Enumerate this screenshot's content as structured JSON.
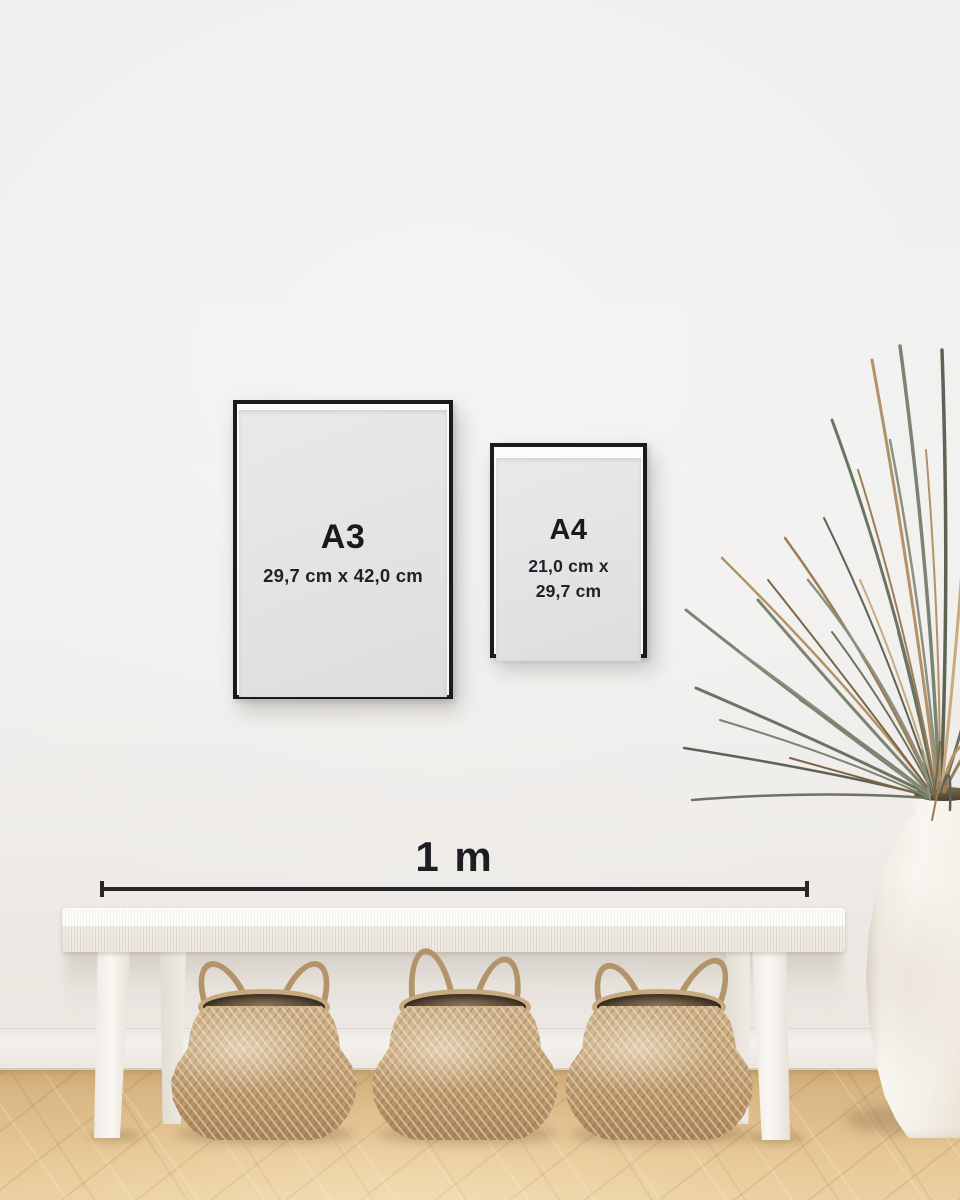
{
  "frames": {
    "a3": {
      "label": "A3",
      "dimensions": "29,7 cm x 42,0 cm"
    },
    "a4": {
      "label": "A4",
      "dimensions_line1": "21,0 cm x",
      "dimensions_line2": "29,7 cm"
    }
  },
  "scale_bar": {
    "label": "1 m"
  },
  "colors": {
    "wall": "#f0efee",
    "floor_wood": "#ddbd8c",
    "frame_border": "#191b1f",
    "frame_paper": "#e4e4e6",
    "text": "#1a1a1d",
    "scale_line": "#27272b",
    "bench_white": "#f6f3ef",
    "basket_tan": "#c6a87c",
    "basket_interior": "#5d4d3a",
    "basket_handle": "#b3946a",
    "vase_cream": "#f2eee6",
    "plant_green": "#6d7363",
    "plant_dried_tan": "#b29266"
  }
}
